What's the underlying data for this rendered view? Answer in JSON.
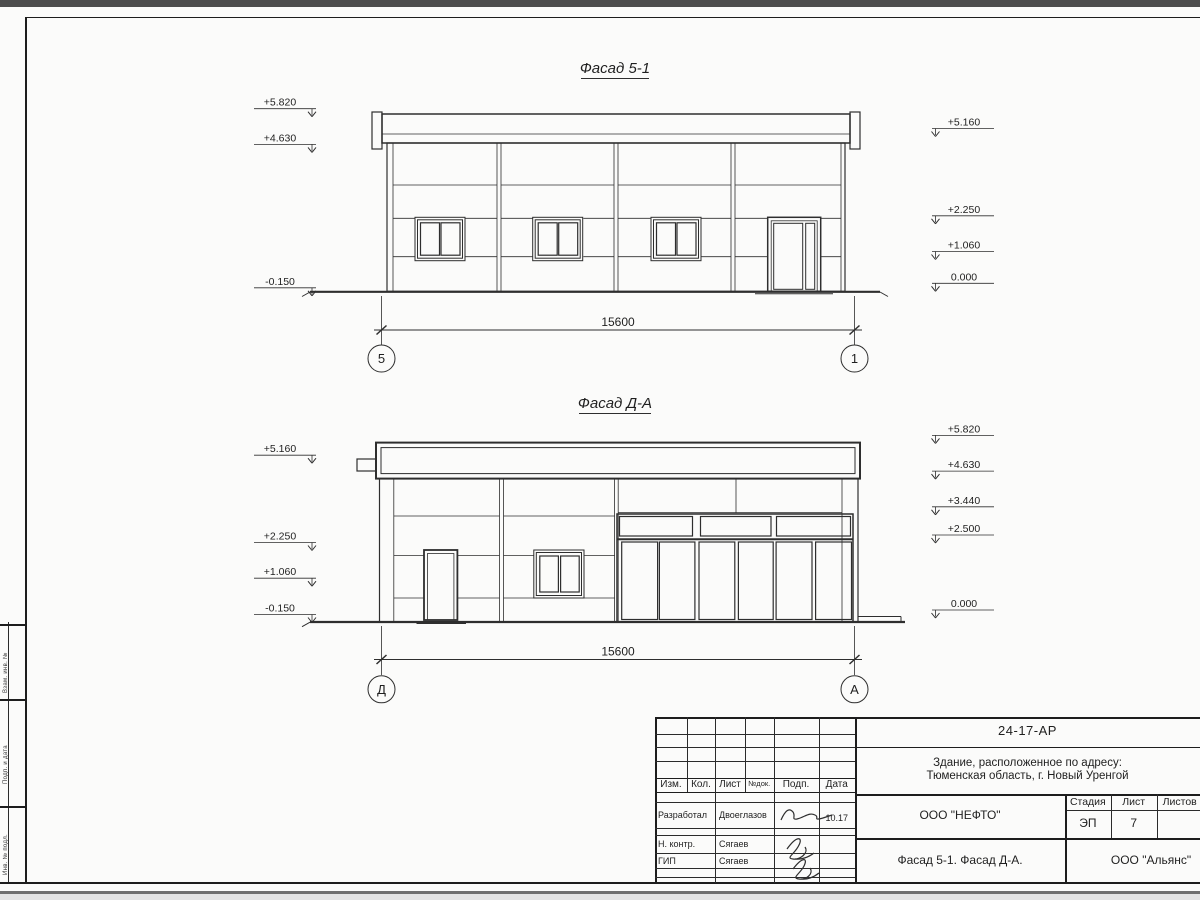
{
  "sheet": {
    "facade1": {
      "title": "Фасад 5-1",
      "dimension": "15600",
      "axis_left": "5",
      "axis_right": "1",
      "marks_left": [
        "+5.820",
        "+4.630",
        "-0.150"
      ],
      "marks_right": [
        "+5.160",
        "+2.250",
        "+1.060",
        "0.000"
      ]
    },
    "facade2": {
      "title": "Фасад Д-А",
      "dimension": "15600",
      "axis_left": "Д",
      "axis_right": "А",
      "marks_left": [
        "+5.160",
        "+2.250",
        "+1.060",
        "-0.150"
      ],
      "marks_right": [
        "+5.820",
        "+4.630",
        "+3.440",
        "+2.500",
        "0.000"
      ]
    },
    "title_block": {
      "doc_code": "24-17-АР",
      "project_name_line1": "Здание, расположенное по адресу:",
      "project_name_line2": "Тюменская область, г. Новый Уренгой",
      "columns": {
        "izm": "Изм.",
        "kol": "Кол.",
        "list": "Лист",
        "ndoc": "№док.",
        "podp": "Подп.",
        "data": "Дата"
      },
      "rows": [
        {
          "role": "Разработал",
          "name": "Двоеглазов",
          "date": "10.17"
        },
        {
          "role": "Н. контр.",
          "name": "Сягаев",
          "date": ""
        },
        {
          "role": "ГИП",
          "name": "Сягаев",
          "date": ""
        }
      ],
      "designer_org": "ООО \"НЕФТО\"",
      "stage_label": "Стадия",
      "sheet_label": "Лист",
      "sheets_label": "Листов",
      "stage": "ЭП",
      "sheet_no": "7",
      "sheet_title": "Фасад 5-1. Фасад Д-А.",
      "contractor_org": "ООО \"Альянс\""
    },
    "margin_stamp": {
      "cells": [
        "Взам. инв. №",
        "Подп. и дата",
        "Инв. № подл."
      ]
    }
  }
}
